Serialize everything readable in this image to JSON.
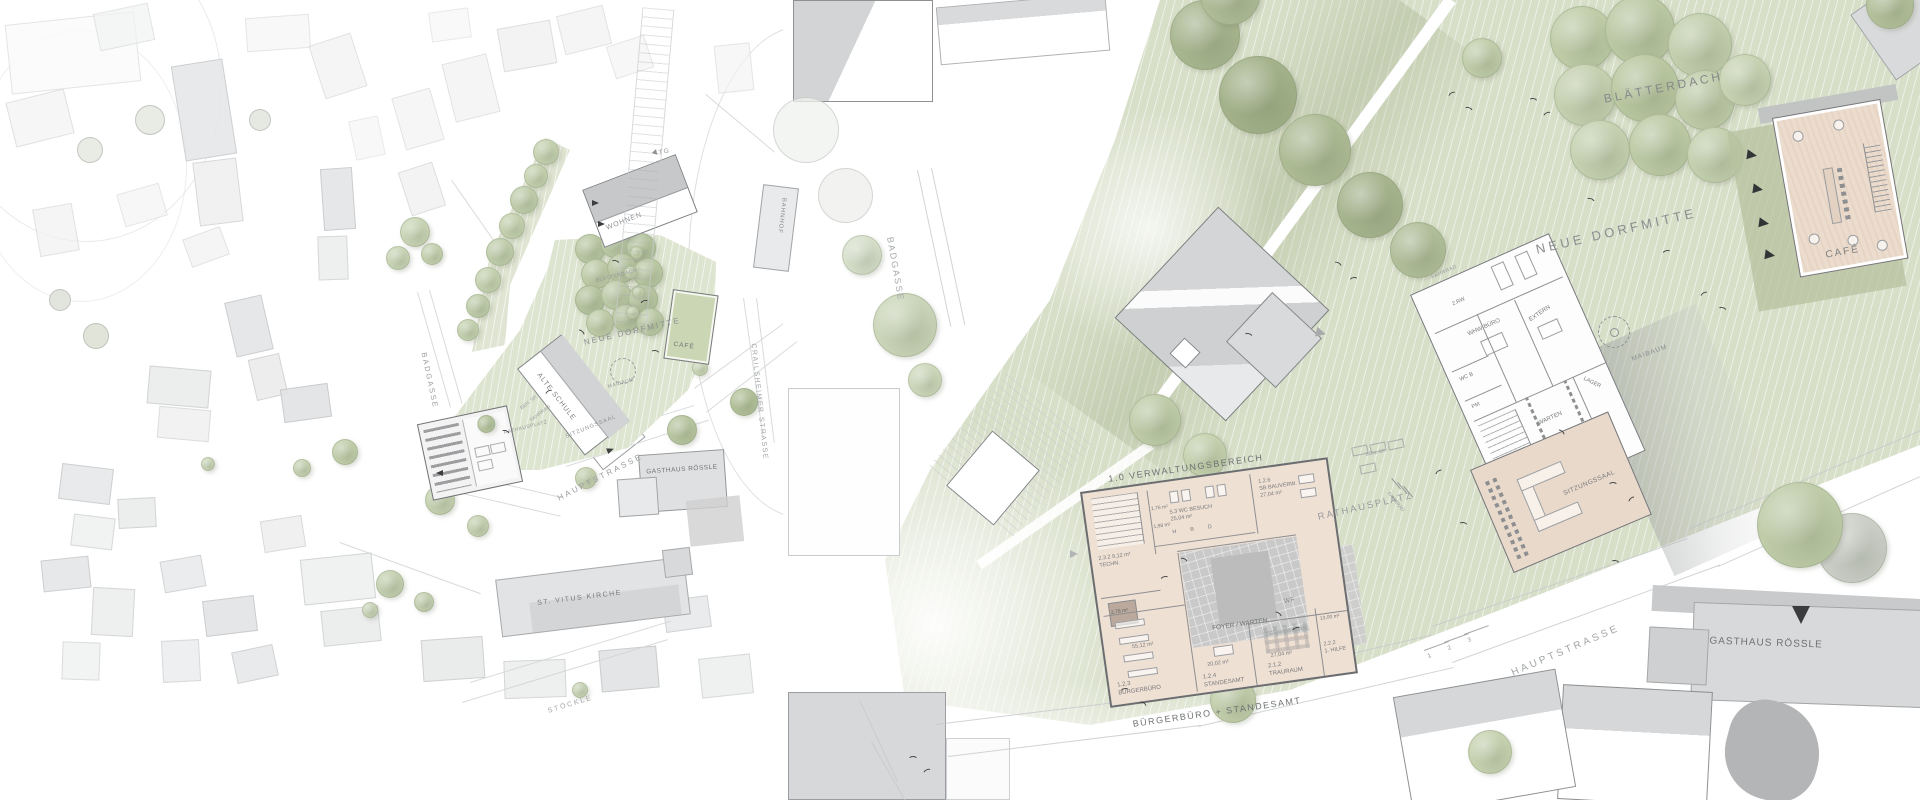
{
  "left": {
    "labels": {
      "tg": "TG",
      "wohnen": "WOHNEN",
      "blaetterdach": "BLÄTTERDACH",
      "neue_dorfmitte": "NEUE DORFMITTE",
      "cafe": "CAFÉ",
      "maibaum": "MAIBAUM",
      "alte_schule": "ALTE SCHULE",
      "sitzungssaal": "SITZUNGSSAAL",
      "rathausplatz": "RATHAUSPLATZ",
      "beh_sp": "BEH. SP.",
      "fahrrad": "FAHRRAD",
      "badgasse": "BADGASSE",
      "hauptstrasse": "HAUPTSTRASSE",
      "gasthaus_roessle": "GASTHAUS RÖSSLE",
      "st_vitus_kirche": "ST. VITUS KIRCHE",
      "stoeckle": "STÖCKLE",
      "bahnhof": "BAHNHOF",
      "crailsheimer_strasse": "CRAILSHEIMER STRASSE"
    }
  },
  "right": {
    "labels": {
      "blaetterdach": "BLÄTTERDACH",
      "neue_dorfmitte": "NEUE DORFMITTE",
      "cafe": "CAFÉ",
      "maibaum": "MAIBAUM",
      "badgasse": "BADGASSE",
      "rathausplatz": "RATHAUSPLATZ",
      "beh_sp": "BEH. SP.",
      "fahrrad": "FAHRRAD",
      "wf": "WF",
      "hauptstrasse": "HAUPTSTRASSE",
      "gasthaus_roessle": "GASTHAUS RÖSSLE",
      "verwaltungsbereich": "1.0 VERWALTUNGSBEREICH",
      "buergerbuero_standesamt": "BÜRGERBÜRO + STANDESAMT"
    },
    "steps": [
      "1",
      "2",
      "3"
    ],
    "rathaus": {
      "techn": {
        "id": "2.3.2",
        "name": "TECHN.",
        "area": "9,12 m²"
      },
      "storage": {
        "area": "2,78 m²"
      },
      "small1": {
        "area": "1,76 m²"
      },
      "small2": {
        "area": "1,98 m²"
      },
      "wc": {
        "id": "5.3",
        "name": "WC BESUCH",
        "area": "25,04 m²",
        "stalls": [
          "H",
          "B",
          "D"
        ]
      },
      "bauverw": {
        "id": "1.2.6",
        "name": "SB BAUVERW.",
        "area": "27,04 m²"
      },
      "foyer": {
        "name": "FOYER / WARTEN"
      },
      "buergerbuero": {
        "id": "1.2.3",
        "name": "BÜRGERBÜRO",
        "area": "55,12 m²"
      },
      "standesamt": {
        "id": "1.2.4",
        "name": "STANDESAMT",
        "area": "20,02 m²"
      },
      "trauraum": {
        "id": "2.1.2",
        "name": "TRAURAUM",
        "area": "27,04 m²"
      },
      "hilfe": {
        "id": "2.2.2",
        "name": "1. HILFE",
        "area": "13,00 m²"
      }
    },
    "annex": {
      "fahrrad": "FAHRRAD",
      "rw": "2.RW",
      "whw": "WHW-BÜRO",
      "extern": "EXTERN",
      "wcb": "WC B",
      "pm": "PM",
      "warten": "WARTEN",
      "lager": "LAGER",
      "wf": "WF",
      "sitzungssaal": "SITZUNGSSAAL"
    }
  },
  "colors": {
    "green_field": "#d8dfc9",
    "tree_sage": "#bfcca8",
    "floor_pink": "#efe0d4",
    "foyer_gray": "#c9c9c9",
    "roof_gray": "#d6d7d8",
    "label_gray": "#8f9294"
  }
}
